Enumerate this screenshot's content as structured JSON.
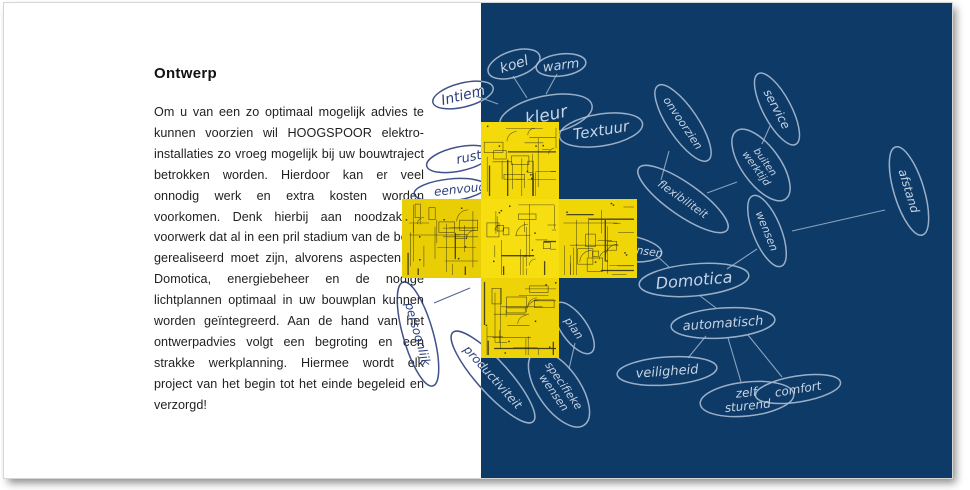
{
  "page": {
    "split_x": 477,
    "left_panel": {
      "heading": "Ontwerp",
      "body": "Om u van een zo optimaal mogelijk advies te kunnen voorzien wil HOOGSPOOR elektro-installaties zo vroeg mogelijk bij uw bouwtraject betrokken worden. Hierdoor kan er veel onnodig werk en extra kosten worden voorkomen. Denk hierbij aan noodzakelijk voorwerk dat al in een pril stadium van de bouw gerealiseerd moet zijn, alvorens aspecten als Domotica, energiebeheer en de nodige lichtplannen optimaal in uw bouwplan kunnen worden geïntegreerd. Aan de hand van het ontwerpadvies volgt een begroting en een strakke werkplanning. Hiermee wordt elk project van het begin tot het einde begeleid en verzorgd!"
    },
    "colors": {
      "background_blue": "#0e3a67",
      "sketch_light": "#a9bdd3",
      "sketch_text": "#c6d4e4",
      "ink_dark": "#2c3f7c",
      "cross_yellow": "#f4da0a",
      "blueprint_line": "#2e2c15",
      "body_text": "#1f1f1f"
    },
    "mindmap": {
      "nodes": [
        {
          "id": "intiem",
          "label": "Intiem",
          "x": 459,
          "y": 92,
          "rx": 31,
          "ry": 12,
          "rot": -14,
          "side": "both",
          "fs": 14
        },
        {
          "id": "koel",
          "label": "koel",
          "x": 510,
          "y": 61,
          "rx": 27,
          "ry": 13,
          "rot": -18,
          "side": "light",
          "fs": 14
        },
        {
          "id": "warm",
          "label": "warm",
          "x": 557,
          "y": 62,
          "rx": 25,
          "ry": 11,
          "rot": -7,
          "side": "light",
          "fs": 13
        },
        {
          "id": "kleur",
          "label": "kleur",
          "x": 542,
          "y": 112,
          "rx": 47,
          "ry": 19,
          "rot": -12,
          "side": "light",
          "fs": 17
        },
        {
          "id": "textuur",
          "label": "Textuur",
          "x": 597,
          "y": 127,
          "rx": 42,
          "ry": 16,
          "rot": -9,
          "side": "light",
          "fs": 15
        },
        {
          "id": "rust",
          "label": "rust",
          "x": 455,
          "y": 156,
          "rx": 33,
          "ry": 12,
          "rot": -12,
          "side": "dark",
          "fs": 13,
          "tx": 10
        },
        {
          "id": "eenvoud",
          "label": "eenvoud",
          "x": 446,
          "y": 187,
          "rx": 36,
          "ry": 11,
          "rot": -6,
          "side": "dark",
          "fs": 12,
          "tx": 10
        },
        {
          "id": "onvoorzien",
          "label": "onvoorzien",
          "x": 679,
          "y": 120,
          "rx": 45,
          "ry": 15,
          "rot": 56,
          "side": "light",
          "fs": 11
        },
        {
          "id": "service",
          "label": "service",
          "x": 773,
          "y": 106,
          "rx": 40,
          "ry": 14,
          "rot": 62,
          "side": "light",
          "fs": 12
        },
        {
          "id": "buiten-werktijd",
          "label": "buiten\nwerktijd",
          "x": 757,
          "y": 162,
          "rx": 42,
          "ry": 19,
          "rot": 54,
          "side": "light",
          "fs": 10
        },
        {
          "id": "afstand",
          "label": "afstand",
          "x": 905,
          "y": 188,
          "rx": 46,
          "ry": 15,
          "rot": 73,
          "side": "light",
          "fs": 12
        },
        {
          "id": "flexibiliteit",
          "label": "flexibiliteit",
          "x": 679,
          "y": 196,
          "rx": 54,
          "ry": 16,
          "rot": 35,
          "side": "light",
          "fs": 11
        },
        {
          "id": "wensen",
          "label": "wensen",
          "x": 763,
          "y": 228,
          "rx": 38,
          "ry": 14,
          "rot": 68,
          "side": "light",
          "fs": 11
        },
        {
          "id": "wensen-partial",
          "label": "wensen",
          "x": 620,
          "y": 245,
          "rx": 38,
          "ry": 13,
          "rot": 8,
          "side": "light",
          "fs": 11,
          "tx": 18
        },
        {
          "id": "domotica",
          "label": "Domotica",
          "x": 690,
          "y": 277,
          "rx": 55,
          "ry": 16,
          "rot": -5,
          "side": "light",
          "fs": 16
        },
        {
          "id": "automatisch",
          "label": "automatisch",
          "x": 719,
          "y": 320,
          "rx": 52,
          "ry": 15,
          "rot": -4,
          "side": "light",
          "fs": 13
        },
        {
          "id": "veiligheid",
          "label": "veiligheid",
          "x": 663,
          "y": 368,
          "rx": 50,
          "ry": 14,
          "rot": -4,
          "side": "light",
          "fs": 13
        },
        {
          "id": "comfort",
          "label": "comfort",
          "x": 794,
          "y": 386,
          "rx": 43,
          "ry": 13,
          "rot": -9,
          "side": "light",
          "fs": 12
        },
        {
          "id": "zelf-sturend",
          "label": "zelf\nsturend",
          "x": 743,
          "y": 396,
          "rx": 47,
          "ry": 17,
          "rot": -6,
          "side": "light",
          "fs": 12
        },
        {
          "id": "plan",
          "label": "plan",
          "x": 570,
          "y": 325,
          "rx": 30,
          "ry": 13,
          "rot": 55,
          "side": "light",
          "fs": 11
        },
        {
          "id": "specifieke-wensen",
          "label": "specifieke\nwensen",
          "x": 555,
          "y": 386,
          "rx": 44,
          "ry": 21,
          "rot": 55,
          "side": "light",
          "fs": 11
        },
        {
          "id": "persoonlijk",
          "label": "persoonlijk",
          "x": 414,
          "y": 331,
          "rx": 54,
          "ry": 15,
          "rot": 74,
          "side": "dark",
          "fs": 12
        },
        {
          "id": "productiviteit",
          "label": "productiviteit",
          "x": 489,
          "y": 374,
          "rx": 60,
          "ry": 16,
          "rot": 48,
          "side": "both",
          "fs": 12
        }
      ],
      "links": [
        {
          "x1": 523,
          "y1": 95,
          "x2": 509,
          "y2": 73,
          "side": "light"
        },
        {
          "x1": 542,
          "y1": 91,
          "x2": 553,
          "y2": 71,
          "side": "light"
        },
        {
          "x1": 494,
          "y1": 101,
          "x2": 472,
          "y2": 93,
          "side": "both"
        },
        {
          "x1": 665,
          "y1": 148,
          "x2": 657,
          "y2": 177,
          "side": "light"
        },
        {
          "x1": 766,
          "y1": 123,
          "x2": 758,
          "y2": 141,
          "side": "light"
        },
        {
          "x1": 733,
          "y1": 179,
          "x2": 703,
          "y2": 190,
          "side": "light"
        },
        {
          "x1": 881,
          "y1": 207,
          "x2": 788,
          "y2": 228,
          "side": "light"
        },
        {
          "x1": 753,
          "y1": 246,
          "x2": 723,
          "y2": 266,
          "side": "light"
        },
        {
          "x1": 652,
          "y1": 252,
          "x2": 665,
          "y2": 264,
          "side": "light"
        },
        {
          "x1": 695,
          "y1": 292,
          "x2": 712,
          "y2": 305,
          "side": "light"
        },
        {
          "x1": 744,
          "y1": 332,
          "x2": 778,
          "y2": 374,
          "side": "light"
        },
        {
          "x1": 702,
          "y1": 333,
          "x2": 684,
          "y2": 355,
          "side": "light"
        },
        {
          "x1": 724,
          "y1": 335,
          "x2": 737,
          "y2": 379,
          "side": "light"
        },
        {
          "x1": 565,
          "y1": 366,
          "x2": 571,
          "y2": 340,
          "side": "light"
        },
        {
          "x1": 430,
          "y1": 300,
          "x2": 466,
          "y2": 285,
          "side": "dark"
        }
      ]
    },
    "cross": {
      "tiles": [
        {
          "x": 398,
          "y": 196,
          "w": 79,
          "h": 79,
          "shade": "#e9cd05"
        },
        {
          "x": 477,
          "y": 119,
          "w": 78,
          "h": 77,
          "shade": "#f4da0a"
        },
        {
          "x": 477,
          "y": 196,
          "w": 78,
          "h": 79,
          "shade": "#f6de10"
        },
        {
          "x": 555,
          "y": 196,
          "w": 78,
          "h": 79,
          "shade": "#f0d507"
        },
        {
          "x": 477,
          "y": 275,
          "w": 78,
          "h": 80,
          "shade": "#eed308"
        }
      ]
    }
  }
}
